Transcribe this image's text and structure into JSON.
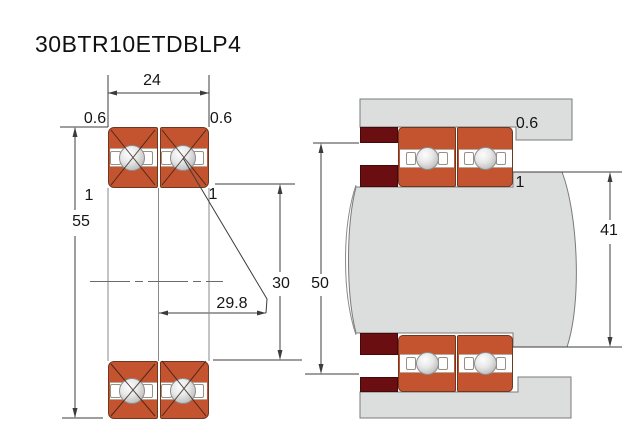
{
  "title": "30BTR10ETDBLP4",
  "left_view": {
    "outer_width_label": "24",
    "outer_diameter_label": "55",
    "bore_label": "30",
    "load_center_label": "29.8",
    "outer_chamfer_left": "0.6",
    "outer_chamfer_right": "0.6",
    "inner_chamfer_left": "1",
    "inner_chamfer_right": "1"
  },
  "right_view": {
    "housing_shoulder_label": "50",
    "shaft_shoulder_label": "41",
    "housing_fillet_label": "0.6",
    "shaft_fillet_label": "1"
  },
  "colors": {
    "ring_orange": "#c4532f",
    "spacer_dark_red": "#6b0e12",
    "steel_gray": "#dcdddd",
    "line": "#3c3c3c"
  }
}
